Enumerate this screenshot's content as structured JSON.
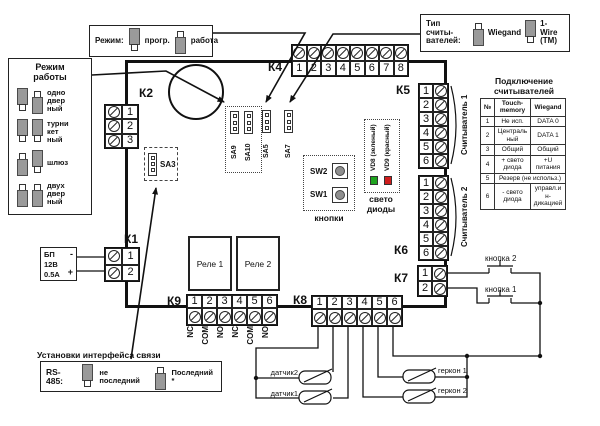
{
  "mode_box": {
    "label": "Режим:",
    "options": [
      {
        "label": "прогр.",
        "jumper": "up"
      },
      {
        "label": "работа",
        "jumper": "down"
      }
    ]
  },
  "reader_type_box": {
    "label": "Тип считы-\nвателей:",
    "options": [
      {
        "label": "Wiegand",
        "jumper": "down"
      },
      {
        "label": "1-Wire\n(ТМ)",
        "jumper": "up"
      }
    ]
  },
  "work_mode_box": {
    "title": "Режим\nработы",
    "rows": [
      {
        "label": "одно\nдвер\nный",
        "j1": "up",
        "j2": "down"
      },
      {
        "label": "турни\nкет\nный",
        "j1": "up",
        "j2": "up"
      },
      {
        "label": "шлюз",
        "j1": "down",
        "j2": "up"
      },
      {
        "label": "двух\nдвер\nный",
        "j1": "down",
        "j2": "down"
      }
    ]
  },
  "connectors": {
    "k1": {
      "label": "К1",
      "terminals": [
        "1",
        "2"
      ]
    },
    "k2": {
      "label": "К2",
      "terminals": [
        "1",
        "2",
        "3"
      ]
    },
    "k4": {
      "label": "К4",
      "terminals": [
        "1",
        "2",
        "3",
        "4",
        "5",
        "6",
        "7",
        "8"
      ]
    },
    "k5": {
      "label": "К5",
      "terminals": [
        "1",
        "2",
        "3",
        "4",
        "5",
        "6"
      ]
    },
    "k6": {
      "label": "К6",
      "terminals": [
        "1",
        "2",
        "3",
        "4",
        "5",
        "6"
      ]
    },
    "k7": {
      "label": "К7",
      "terminals": [
        "1",
        "2"
      ]
    },
    "k8": {
      "label": "К8",
      "terminals": [
        "1",
        "2",
        "3",
        "4",
        "5",
        "6"
      ]
    },
    "k9": {
      "label": "К9",
      "terminals": [
        "1",
        "2",
        "3",
        "4",
        "5",
        "6"
      ],
      "pin_labels": [
        "NC",
        "COM",
        "NO",
        "NC",
        "COM",
        "NO"
      ]
    }
  },
  "psu": {
    "line1": "БП",
    "line2": "12В",
    "line3": "0.5А",
    "minus": "-",
    "plus": "+"
  },
  "relays": {
    "r1": "Реле 1",
    "r2": "Реле 2"
  },
  "buttons_box": {
    "caption": "кнопки",
    "sw2": "SW2",
    "sw1": "SW1"
  },
  "leds_box": {
    "caption": "свето\nдиоды",
    "vd8": "VD8 (зеленый)",
    "vd9": "VD9 (красный)",
    "green": "#1fa41f",
    "red": "#cf1d1d"
  },
  "jumpers": {
    "sa3": "SA3",
    "sa5": "SA5",
    "sa7": "SA7",
    "sa9": "SA9",
    "sa10": "SA10"
  },
  "readers": {
    "r1": "Считыватель 1",
    "r2": "Считыватель 2"
  },
  "reader_table": {
    "title": "Подключение\nсчитывателей",
    "headers": [
      "№",
      "Touch-\nmemory",
      "Wiegand"
    ],
    "rows": [
      [
        "1",
        "Не исп.",
        "DATA 0"
      ],
      [
        "2",
        "Центральный",
        "DATA 1"
      ],
      [
        "3",
        "Общий",
        "Общий"
      ],
      [
        "4",
        "+ свето диода",
        "+U питания"
      ],
      [
        "5",
        "Резерв (не использ.)"
      ],
      [
        "6",
        "- свето диода",
        "управл.ин-дикацией"
      ]
    ]
  },
  "rs485_box": {
    "title": "Установки интерфейса связи",
    "label": "RS-485:",
    "options": [
      {
        "label": "не последний",
        "jumper": "up"
      },
      {
        "label": "Последний *",
        "jumper": "down"
      }
    ]
  },
  "external": {
    "button2": "кнопка 2",
    "button1": "кнопка 1",
    "sensor2": "датчик2",
    "sensor1": "датчик1",
    "reed1": "геркон 1",
    "reed2": "геркон 2"
  }
}
